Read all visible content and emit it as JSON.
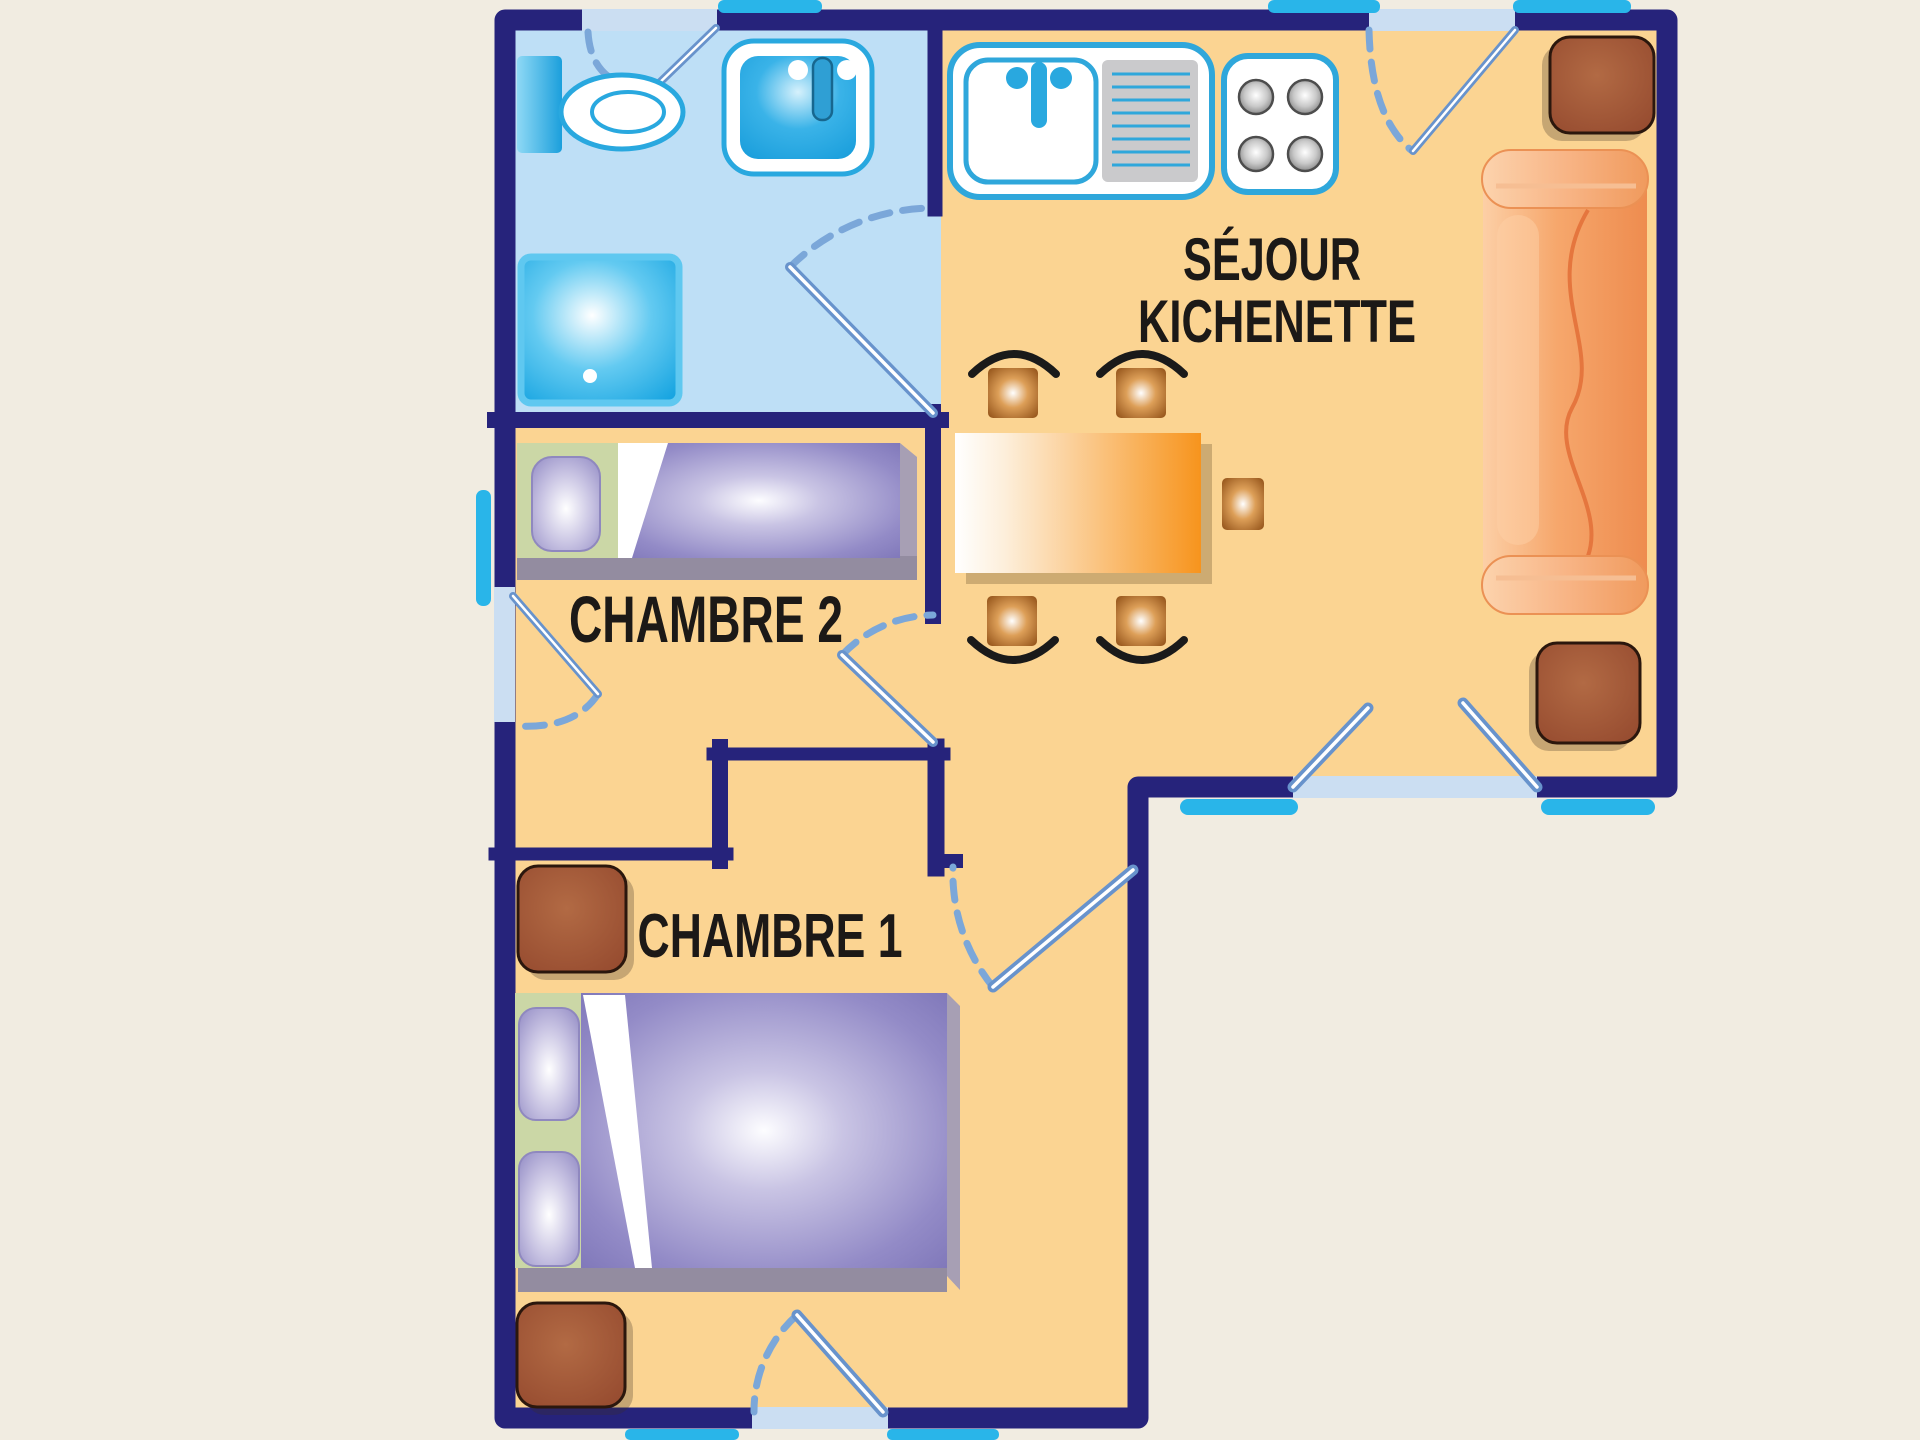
{
  "rooms": {
    "sejour": {
      "label_line1": "SÉJOUR",
      "label_line2": "KICHENETTE"
    },
    "chambre2": {
      "label": "CHAMBRE 2"
    },
    "chambre1": {
      "label": "CHAMBRE 1"
    },
    "bathroom": {
      "label": ""
    }
  },
  "furniture": {
    "bathroom": [
      "toilet-icon",
      "bathroom-sink-icon",
      "shower-icon"
    ],
    "sejour": [
      "kitchen-sink-icon",
      "stove-icon",
      "dining-table-icon",
      "chair-icon",
      "chair-icon",
      "chair-icon",
      "chair-icon",
      "stool-icon",
      "sofa-icon",
      "side-table-icon",
      "side-table-icon"
    ],
    "chambre2": [
      "single-bed-icon"
    ],
    "chambre1": [
      "double-bed-icon",
      "nightstand-icon",
      "nightstand-icon"
    ]
  },
  "openings": {
    "windows": 3,
    "window_sills": 8,
    "interior_doors": 3,
    "exterior_doors": 3
  },
  "colors": {
    "outside": "#F1ECE1",
    "wall": "#26237B",
    "floor": "#FBD492",
    "bath": "#BEDFF6",
    "tab": "#29B5E9",
    "opening": "#CBDEF2",
    "leaf": "#6893CC",
    "arc": "#7BA7D9",
    "text": "#1C1917",
    "headboard": "#CBD7A6",
    "blanket": "#7F77B9",
    "table": "#F7941D",
    "sofa": "#F6A76C",
    "wood": "#9C5033",
    "fixture": "#1FA8E4"
  }
}
